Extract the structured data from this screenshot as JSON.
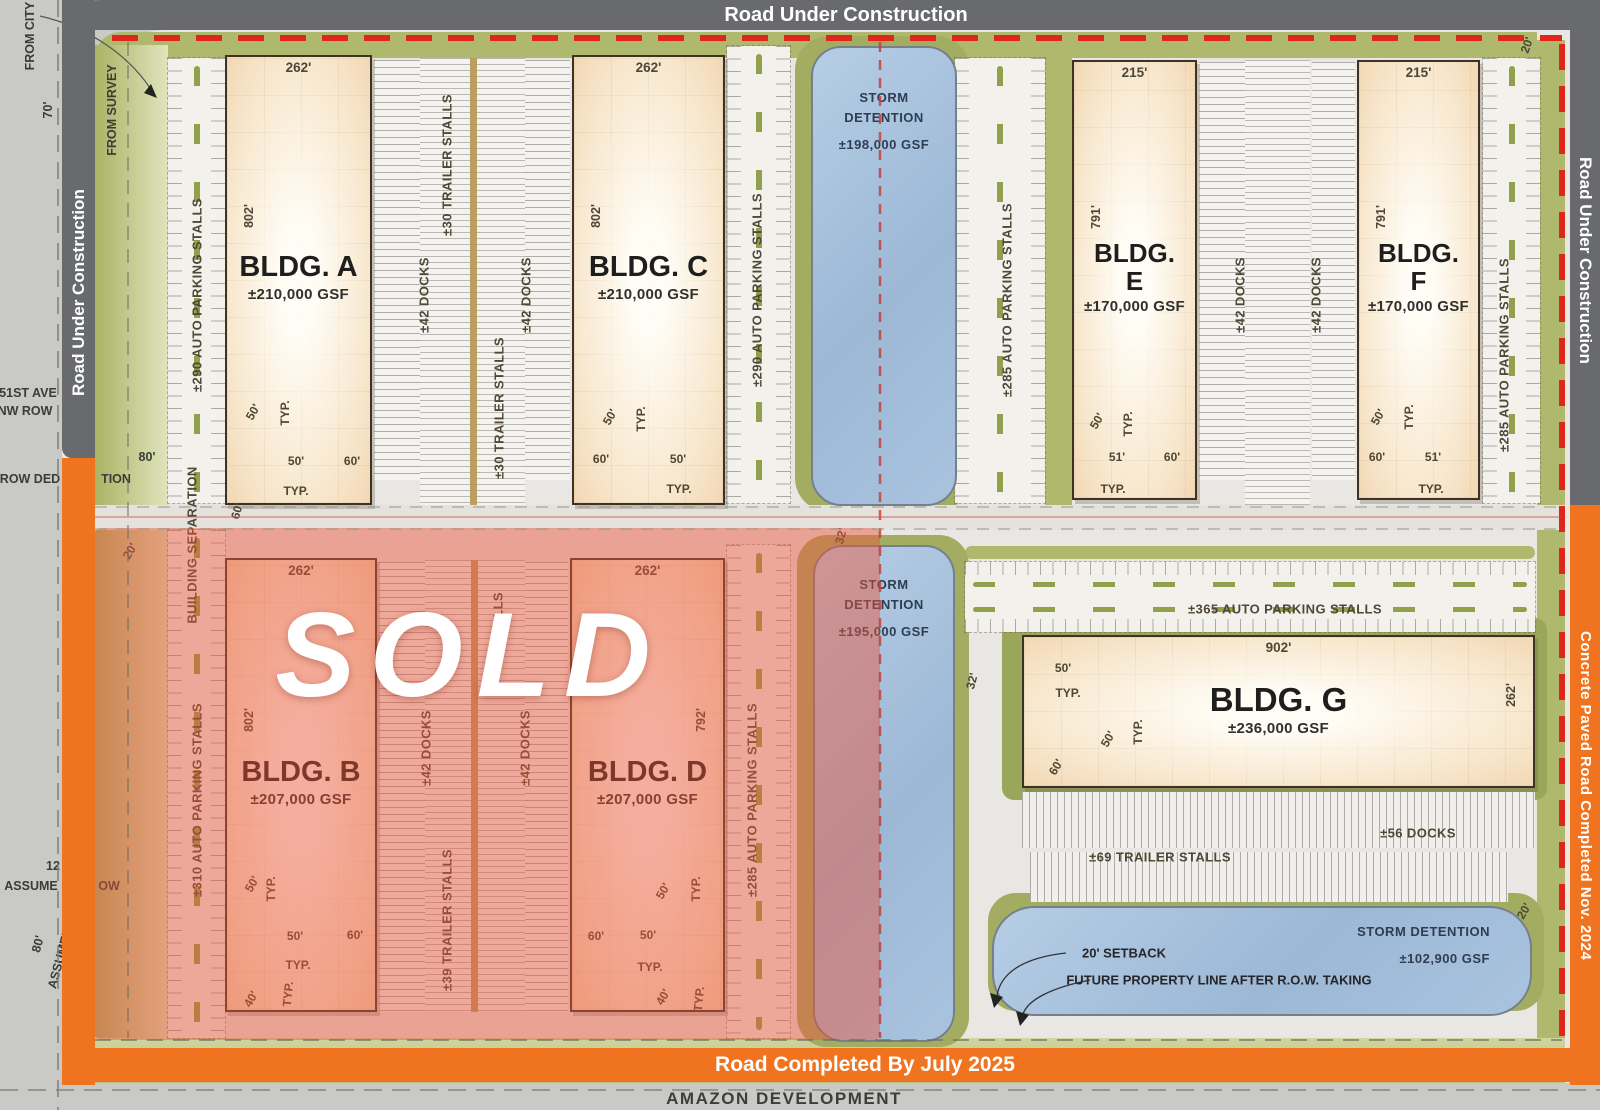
{
  "roads": {
    "top": "Road Under Construction",
    "left": "Road Under Construction",
    "right": "Road Under Construction",
    "right_orange": "Concrete Paved Road Completed Nov. 2024",
    "bottom_orange": "Road Completed By July 2025",
    "amazon": "AMAZON DEVELOPMENT"
  },
  "sold": {
    "label": "SOLD"
  },
  "colors": {
    "road_gray": "#696a6d",
    "orange": "#f0731f",
    "red_dash": "#e0251b",
    "pond_blue": "#a9c2de",
    "landscape_green": "#aeb96e",
    "sold_overlay": "rgba(233,85,60,0.47)"
  },
  "buildings": [
    {
      "key": "A",
      "name_lines": [
        "BLDG. A"
      ],
      "gsf": "±210,000 GSF",
      "top_dim": "262'",
      "side_dim": "802'",
      "side": "left",
      "sold": false,
      "x": 225,
      "y": 55,
      "w": 147,
      "h": 450
    },
    {
      "key": "C",
      "name_lines": [
        "BLDG. C"
      ],
      "gsf": "±210,000 GSF",
      "top_dim": "262'",
      "side_dim": "802'",
      "side": "left",
      "sold": false,
      "x": 572,
      "y": 55,
      "w": 153,
      "h": 450
    },
    {
      "key": "E",
      "name_lines": [
        "BLDG.",
        "E"
      ],
      "gsf": "±170,000 GSF",
      "top_dim": "215'",
      "side_dim": "791'",
      "side": "left",
      "sold": false,
      "x": 1072,
      "y": 60,
      "w": 125,
      "h": 440
    },
    {
      "key": "F",
      "name_lines": [
        "BLDG.",
        "F"
      ],
      "gsf": "±170,000 GSF",
      "top_dim": "215'",
      "side_dim": "791'",
      "side": "left",
      "sold": false,
      "x": 1357,
      "y": 60,
      "w": 123,
      "h": 440
    },
    {
      "key": "B",
      "name_lines": [
        "BLDG. B"
      ],
      "gsf": "±207,000 GSF",
      "top_dim": "262'",
      "side_dim": "802'",
      "side": "left",
      "sold": true,
      "x": 225,
      "y": 558,
      "w": 152,
      "h": 454
    },
    {
      "key": "D",
      "name_lines": [
        "BLDG. D"
      ],
      "gsf": "±207,000 GSF",
      "top_dim": "262'",
      "side_dim": "792'",
      "side": "right",
      "sold": true,
      "x": 570,
      "y": 558,
      "w": 155,
      "h": 454
    },
    {
      "key": "G",
      "name_lines": [
        "BLDG. G"
      ],
      "gsf": "±236,000 GSF",
      "top_dim": "902'",
      "side_dim": "262'",
      "side": "right",
      "sold": false,
      "x": 1022,
      "y": 635,
      "w": 513,
      "h": 153
    }
  ],
  "ponds": [
    {
      "lines": [
        "STORM",
        "DETENTION"
      ],
      "gsf": "±198,000 GSF",
      "align": "center",
      "pad_top": 40,
      "x": 811,
      "y": 46,
      "w": 146,
      "h": 460,
      "r": 30
    },
    {
      "lines": [
        "STORM",
        "DETENTION"
      ],
      "gsf": "±195,000 GSF",
      "align": "center",
      "pad_top": 28,
      "x": 813,
      "y": 545,
      "w": 142,
      "h": 497,
      "r": 30
    },
    {
      "lines": [
        "STORM DETENTION"
      ],
      "gsf": "±102,900 GSF",
      "align": "right",
      "pad_top": 14,
      "x": 992,
      "y": 906,
      "w": 540,
      "h": 110,
      "r": 42
    }
  ],
  "annotations": [
    {
      "t": "FROM CITY",
      "x": 30,
      "y": 36,
      "r": -90,
      "c": "m"
    },
    {
      "t": "70'",
      "x": 48,
      "y": 110,
      "r": -90,
      "c": "m"
    },
    {
      "t": "FROM SURVEY",
      "x": 112,
      "y": 110,
      "r": -90,
      "c": "m"
    },
    {
      "t": "51ST AVE",
      "x": 28,
      "y": 393,
      "r": 0,
      "c": "m"
    },
    {
      "t": "NW ROW",
      "x": 25,
      "y": 411,
      "r": 0,
      "c": "m"
    },
    {
      "t": "80'",
      "x": 147,
      "y": 457,
      "r": 0,
      "c": "m"
    },
    {
      "t": "ROW DED",
      "x": 30,
      "y": 479,
      "r": 0,
      "c": "m"
    },
    {
      "t": "TION",
      "x": 116,
      "y": 479,
      "r": 0,
      "c": "m"
    },
    {
      "t": "12",
      "x": 53,
      "y": 866,
      "r": 0,
      "c": "m"
    },
    {
      "t": "ASSUME",
      "x": 31,
      "y": 886,
      "r": 0,
      "c": "m"
    },
    {
      "t": "OW",
      "x": 109,
      "y": 886,
      "r": 0,
      "c": "m"
    },
    {
      "t": "80'",
      "x": 38,
      "y": 944,
      "r": -75,
      "c": "m"
    },
    {
      "t": "ASSUMED",
      "x": 60,
      "y": 958,
      "r": -75,
      "c": "m"
    },
    {
      "t": "±290 AUTO PARKING STALLS",
      "x": 197,
      "y": 295,
      "r": -90,
      "c": "p"
    },
    {
      "t": "±30 TRAILER STALLS",
      "x": 447,
      "y": 165,
      "r": -90,
      "c": "p"
    },
    {
      "t": "±42 DOCKS",
      "x": 424,
      "y": 295,
      "r": -90,
      "c": "p"
    },
    {
      "t": "±42 DOCKS",
      "x": 526,
      "y": 295,
      "r": -90,
      "c": "p"
    },
    {
      "t": "±30 TRAILER STALLS",
      "x": 499,
      "y": 408,
      "r": -90,
      "c": "p"
    },
    {
      "t": "±290 AUTO PARKING STALLS",
      "x": 757,
      "y": 290,
      "r": -90,
      "c": "p"
    },
    {
      "t": "±285 AUTO PARKING STALLS",
      "x": 1007,
      "y": 300,
      "r": -90,
      "c": "p"
    },
    {
      "t": "±42 DOCKS",
      "x": 1240,
      "y": 295,
      "r": -90,
      "c": "p"
    },
    {
      "t": "±42 DOCKS",
      "x": 1316,
      "y": 295,
      "r": -90,
      "c": "p"
    },
    {
      "t": "±285 AUTO PARKING STALLS",
      "x": 1504,
      "y": 355,
      "r": -90,
      "c": "p"
    },
    {
      "t": "BUILDING SEPARATION",
      "x": 192,
      "y": 545,
      "r": -90,
      "c": "p"
    },
    {
      "t": "±310 AUTO PARKING STALLS",
      "x": 197,
      "y": 800,
      "r": -90,
      "c": "p"
    },
    {
      "t": "STALLS",
      "x": 498,
      "y": 618,
      "r": -90,
      "c": "p"
    },
    {
      "t": "±42 DOCKS",
      "x": 426,
      "y": 748,
      "r": -90,
      "c": "p"
    },
    {
      "t": "±42 DOCKS",
      "x": 525,
      "y": 748,
      "r": -90,
      "c": "p"
    },
    {
      "t": "±39 TRAILER STALLS",
      "x": 447,
      "y": 920,
      "r": -90,
      "c": "p"
    },
    {
      "t": "±285 AUTO PARKING STALLS",
      "x": 752,
      "y": 800,
      "r": -90,
      "c": "p"
    },
    {
      "t": "±365 AUTO PARKING STALLS",
      "x": 1285,
      "y": 609,
      "r": 0,
      "c": "p"
    },
    {
      "t": "±56 DOCKS",
      "x": 1418,
      "y": 833,
      "r": 0,
      "c": "p"
    },
    {
      "t": "±69 TRAILER STALLS",
      "x": 1160,
      "y": 857,
      "r": 0,
      "c": "p"
    },
    {
      "t": "50'",
      "x": 253,
      "y": 412,
      "r": -60,
      "c": "d"
    },
    {
      "t": "TYP.",
      "x": 285,
      "y": 413,
      "r": -90,
      "c": "d"
    },
    {
      "t": "50'",
      "x": 296,
      "y": 461,
      "r": 0,
      "c": "d"
    },
    {
      "t": "60'",
      "x": 352,
      "y": 461,
      "r": 0,
      "c": "d"
    },
    {
      "t": "TYP.",
      "x": 296,
      "y": 491,
      "r": 0,
      "c": "d"
    },
    {
      "t": "50'",
      "x": 610,
      "y": 417,
      "r": -60,
      "c": "d"
    },
    {
      "t": "TYP.",
      "x": 641,
      "y": 419,
      "r": -90,
      "c": "d"
    },
    {
      "t": "60'",
      "x": 601,
      "y": 459,
      "r": 0,
      "c": "d"
    },
    {
      "t": "50'",
      "x": 678,
      "y": 459,
      "r": 0,
      "c": "d"
    },
    {
      "t": "TYP.",
      "x": 679,
      "y": 489,
      "r": 0,
      "c": "d"
    },
    {
      "t": "50'",
      "x": 1097,
      "y": 421,
      "r": -60,
      "c": "d"
    },
    {
      "t": "TYP.",
      "x": 1128,
      "y": 424,
      "r": -90,
      "c": "d"
    },
    {
      "t": "51'",
      "x": 1117,
      "y": 457,
      "r": 0,
      "c": "d"
    },
    {
      "t": "60'",
      "x": 1172,
      "y": 457,
      "r": 0,
      "c": "d"
    },
    {
      "t": "TYP.",
      "x": 1113,
      "y": 489,
      "r": 0,
      "c": "d"
    },
    {
      "t": "50'",
      "x": 1378,
      "y": 417,
      "r": -60,
      "c": "d"
    },
    {
      "t": "TYP.",
      "x": 1409,
      "y": 417,
      "r": -90,
      "c": "d"
    },
    {
      "t": "60'",
      "x": 1377,
      "y": 457,
      "r": 0,
      "c": "d"
    },
    {
      "t": "51'",
      "x": 1433,
      "y": 457,
      "r": 0,
      "c": "d"
    },
    {
      "t": "TYP.",
      "x": 1431,
      "y": 489,
      "r": 0,
      "c": "d"
    },
    {
      "t": "50'",
      "x": 252,
      "y": 884,
      "r": -60,
      "c": "d"
    },
    {
      "t": "TYP.",
      "x": 271,
      "y": 889,
      "r": -90,
      "c": "d"
    },
    {
      "t": "50'",
      "x": 295,
      "y": 936,
      "r": 0,
      "c": "d"
    },
    {
      "t": "60'",
      "x": 355,
      "y": 935,
      "r": 0,
      "c": "d"
    },
    {
      "t": "TYP.",
      "x": 298,
      "y": 965,
      "r": 0,
      "c": "d"
    },
    {
      "t": "40'",
      "x": 251,
      "y": 999,
      "r": -60,
      "c": "d"
    },
    {
      "t": "TYP.",
      "x": 288,
      "y": 994,
      "r": -85,
      "c": "d"
    },
    {
      "t": "50'",
      "x": 663,
      "y": 891,
      "r": -60,
      "c": "d"
    },
    {
      "t": "TYP.",
      "x": 696,
      "y": 889,
      "r": -90,
      "c": "d"
    },
    {
      "t": "60'",
      "x": 596,
      "y": 936,
      "r": 0,
      "c": "d"
    },
    {
      "t": "50'",
      "x": 648,
      "y": 935,
      "r": 0,
      "c": "d"
    },
    {
      "t": "TYP.",
      "x": 650,
      "y": 967,
      "r": 0,
      "c": "d"
    },
    {
      "t": "40'",
      "x": 663,
      "y": 997,
      "r": -60,
      "c": "d"
    },
    {
      "t": "TYP.",
      "x": 699,
      "y": 999,
      "r": -85,
      "c": "d"
    },
    {
      "t": "50'",
      "x": 1063,
      "y": 668,
      "r": 0,
      "c": "d"
    },
    {
      "t": "TYP.",
      "x": 1068,
      "y": 693,
      "r": 0,
      "c": "d"
    },
    {
      "t": "50'",
      "x": 1108,
      "y": 739,
      "r": -60,
      "c": "d"
    },
    {
      "t": "TYP.",
      "x": 1138,
      "y": 732,
      "r": -90,
      "c": "d"
    },
    {
      "t": "60'",
      "x": 1056,
      "y": 767,
      "r": -60,
      "c": "d"
    },
    {
      "t": "60'",
      "x": 237,
      "y": 511,
      "r": -75,
      "c": "d"
    },
    {
      "t": "20'",
      "x": 130,
      "y": 551,
      "r": -60,
      "c": "d"
    },
    {
      "t": "32'",
      "x": 841,
      "y": 536,
      "r": -75,
      "c": "d"
    },
    {
      "t": "32'",
      "x": 972,
      "y": 681,
      "r": -75,
      "c": "d"
    },
    {
      "t": "20'",
      "x": 1527,
      "y": 45,
      "r": -70,
      "c": "d"
    },
    {
      "t": "20'",
      "x": 1524,
      "y": 911,
      "r": -60,
      "c": "d"
    },
    {
      "t": "20' SETBACK",
      "x": 1124,
      "y": 953,
      "r": 0,
      "c": "n"
    },
    {
      "t": "FUTURE PROPERTY LINE AFTER R.O.W. TAKING",
      "x": 1219,
      "y": 980,
      "r": 0,
      "c": "n"
    }
  ]
}
